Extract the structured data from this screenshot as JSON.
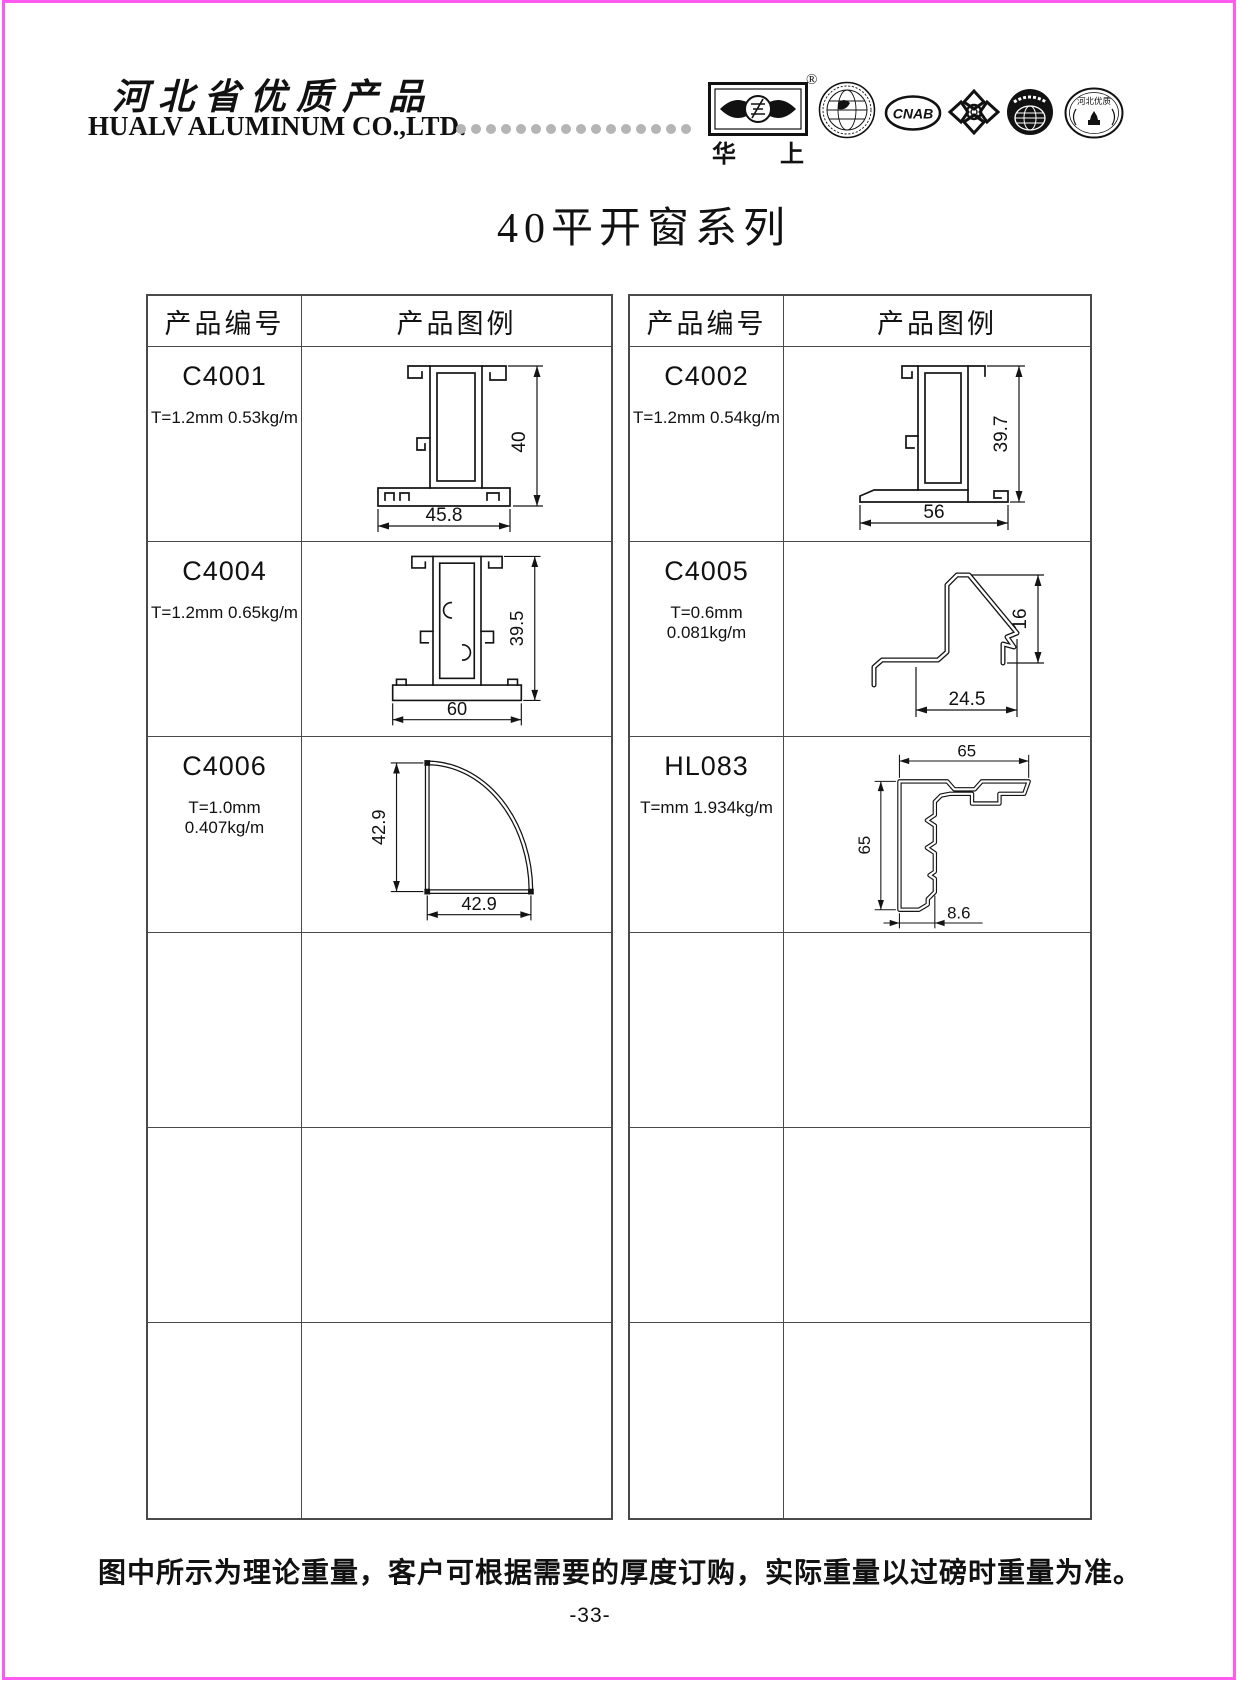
{
  "header": {
    "region_title": "河北省优质产品",
    "company_name": "HUALV ALUMINUM CO.,LTD.",
    "registered_mark": "®",
    "brand_char_1": "华",
    "brand_char_2": "上",
    "cnab_label": "CNAB",
    "hebei_oval_label": "河北优质",
    "logo_names": [
      "huashang-eye-logo",
      "globe-certification-logo",
      "cnab-logo",
      "quality-knot-logo",
      "world-map-logo",
      "hebei-quality-oval-logo"
    ]
  },
  "page_title": "40平开窗系列",
  "table": {
    "col1": "产品编号",
    "col2": "产品图例"
  },
  "products": {
    "c4001": {
      "code": "C4001",
      "spec": "T=1.2mm 0.53kg/m",
      "dim_h": "40",
      "dim_w": "45.8"
    },
    "c4002": {
      "code": "C4002",
      "spec": "T=1.2mm 0.54kg/m",
      "dim_h": "39.7",
      "dim_w": "56"
    },
    "c4004": {
      "code": "C4004",
      "spec": "T=1.2mm 0.65kg/m",
      "dim_h": "39.5",
      "dim_w": "60"
    },
    "c4005": {
      "code": "C4005",
      "spec": "T=0.6mm 0.081kg/m",
      "dim_h": "16",
      "dim_w": "24.5"
    },
    "c4006": {
      "code": "C4006",
      "spec": "T=1.0mm 0.407kg/m",
      "dim_h": "42.9",
      "dim_w": "42.9"
    },
    "hl083": {
      "code": "HL083",
      "spec": "T=mm 1.934kg/m",
      "dim_top": "65",
      "dim_left": "65",
      "dim_offset": "8.6"
    }
  },
  "footer": {
    "note": "图中所示为理论重量，客户可根据需要的厚度订购，实际重量以过磅时重量为准。",
    "page_number": "-33-"
  }
}
